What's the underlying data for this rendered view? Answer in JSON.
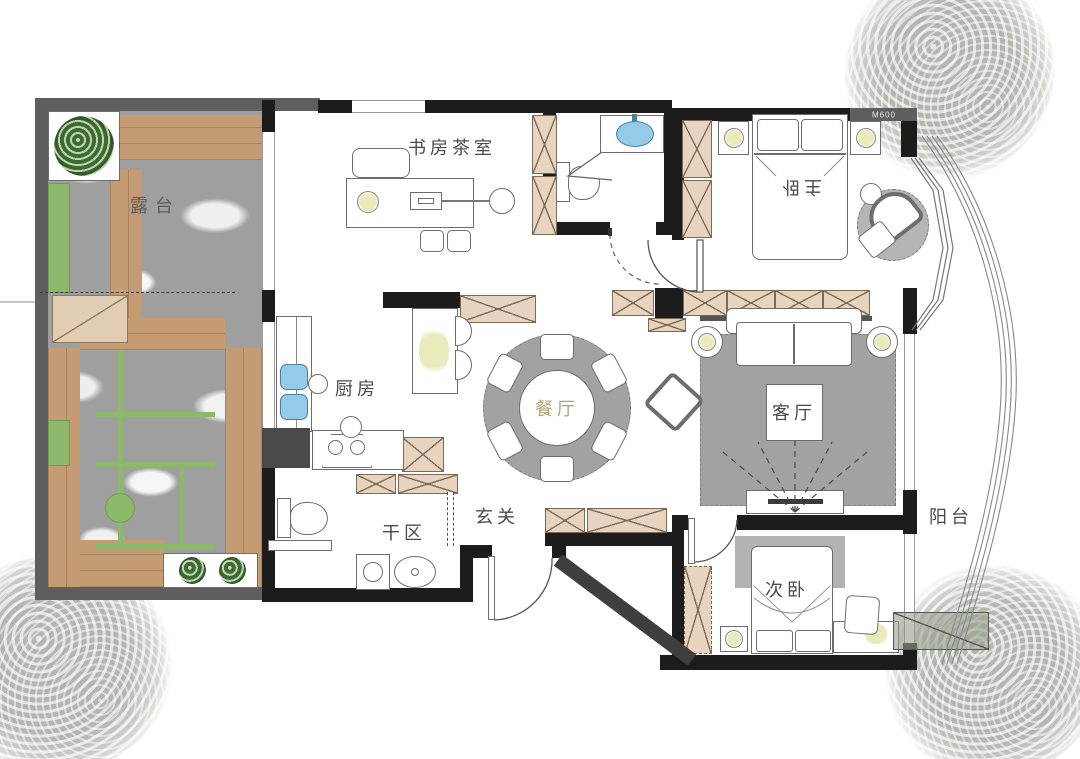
{
  "labels": {
    "terrace": "露台",
    "study": "书房茶室",
    "master": "主卧",
    "kitchen": "厨房",
    "dining": "餐厅",
    "living": "客厅",
    "foyer": "玄关",
    "dry_area": "干区",
    "second_bedroom": "次卧",
    "balcony": "阳台",
    "wall_tag": "M600"
  },
  "colors": {
    "wall": "#1c1c1c",
    "terrace_wall": "#5e5e5e",
    "wood": "#c49b72",
    "stone": "#9f9f9f",
    "green": "#8cb86a",
    "tree_green": "#3e6b34",
    "cabinet": "#e8d3be",
    "cabinet_line": "#7a6a58",
    "rug": "#a2a2a2",
    "sink_blue": "#93cbe8",
    "lamp": "#e9ebbd",
    "label": "#4a4a4a",
    "dining_label": "#a8a878"
  }
}
